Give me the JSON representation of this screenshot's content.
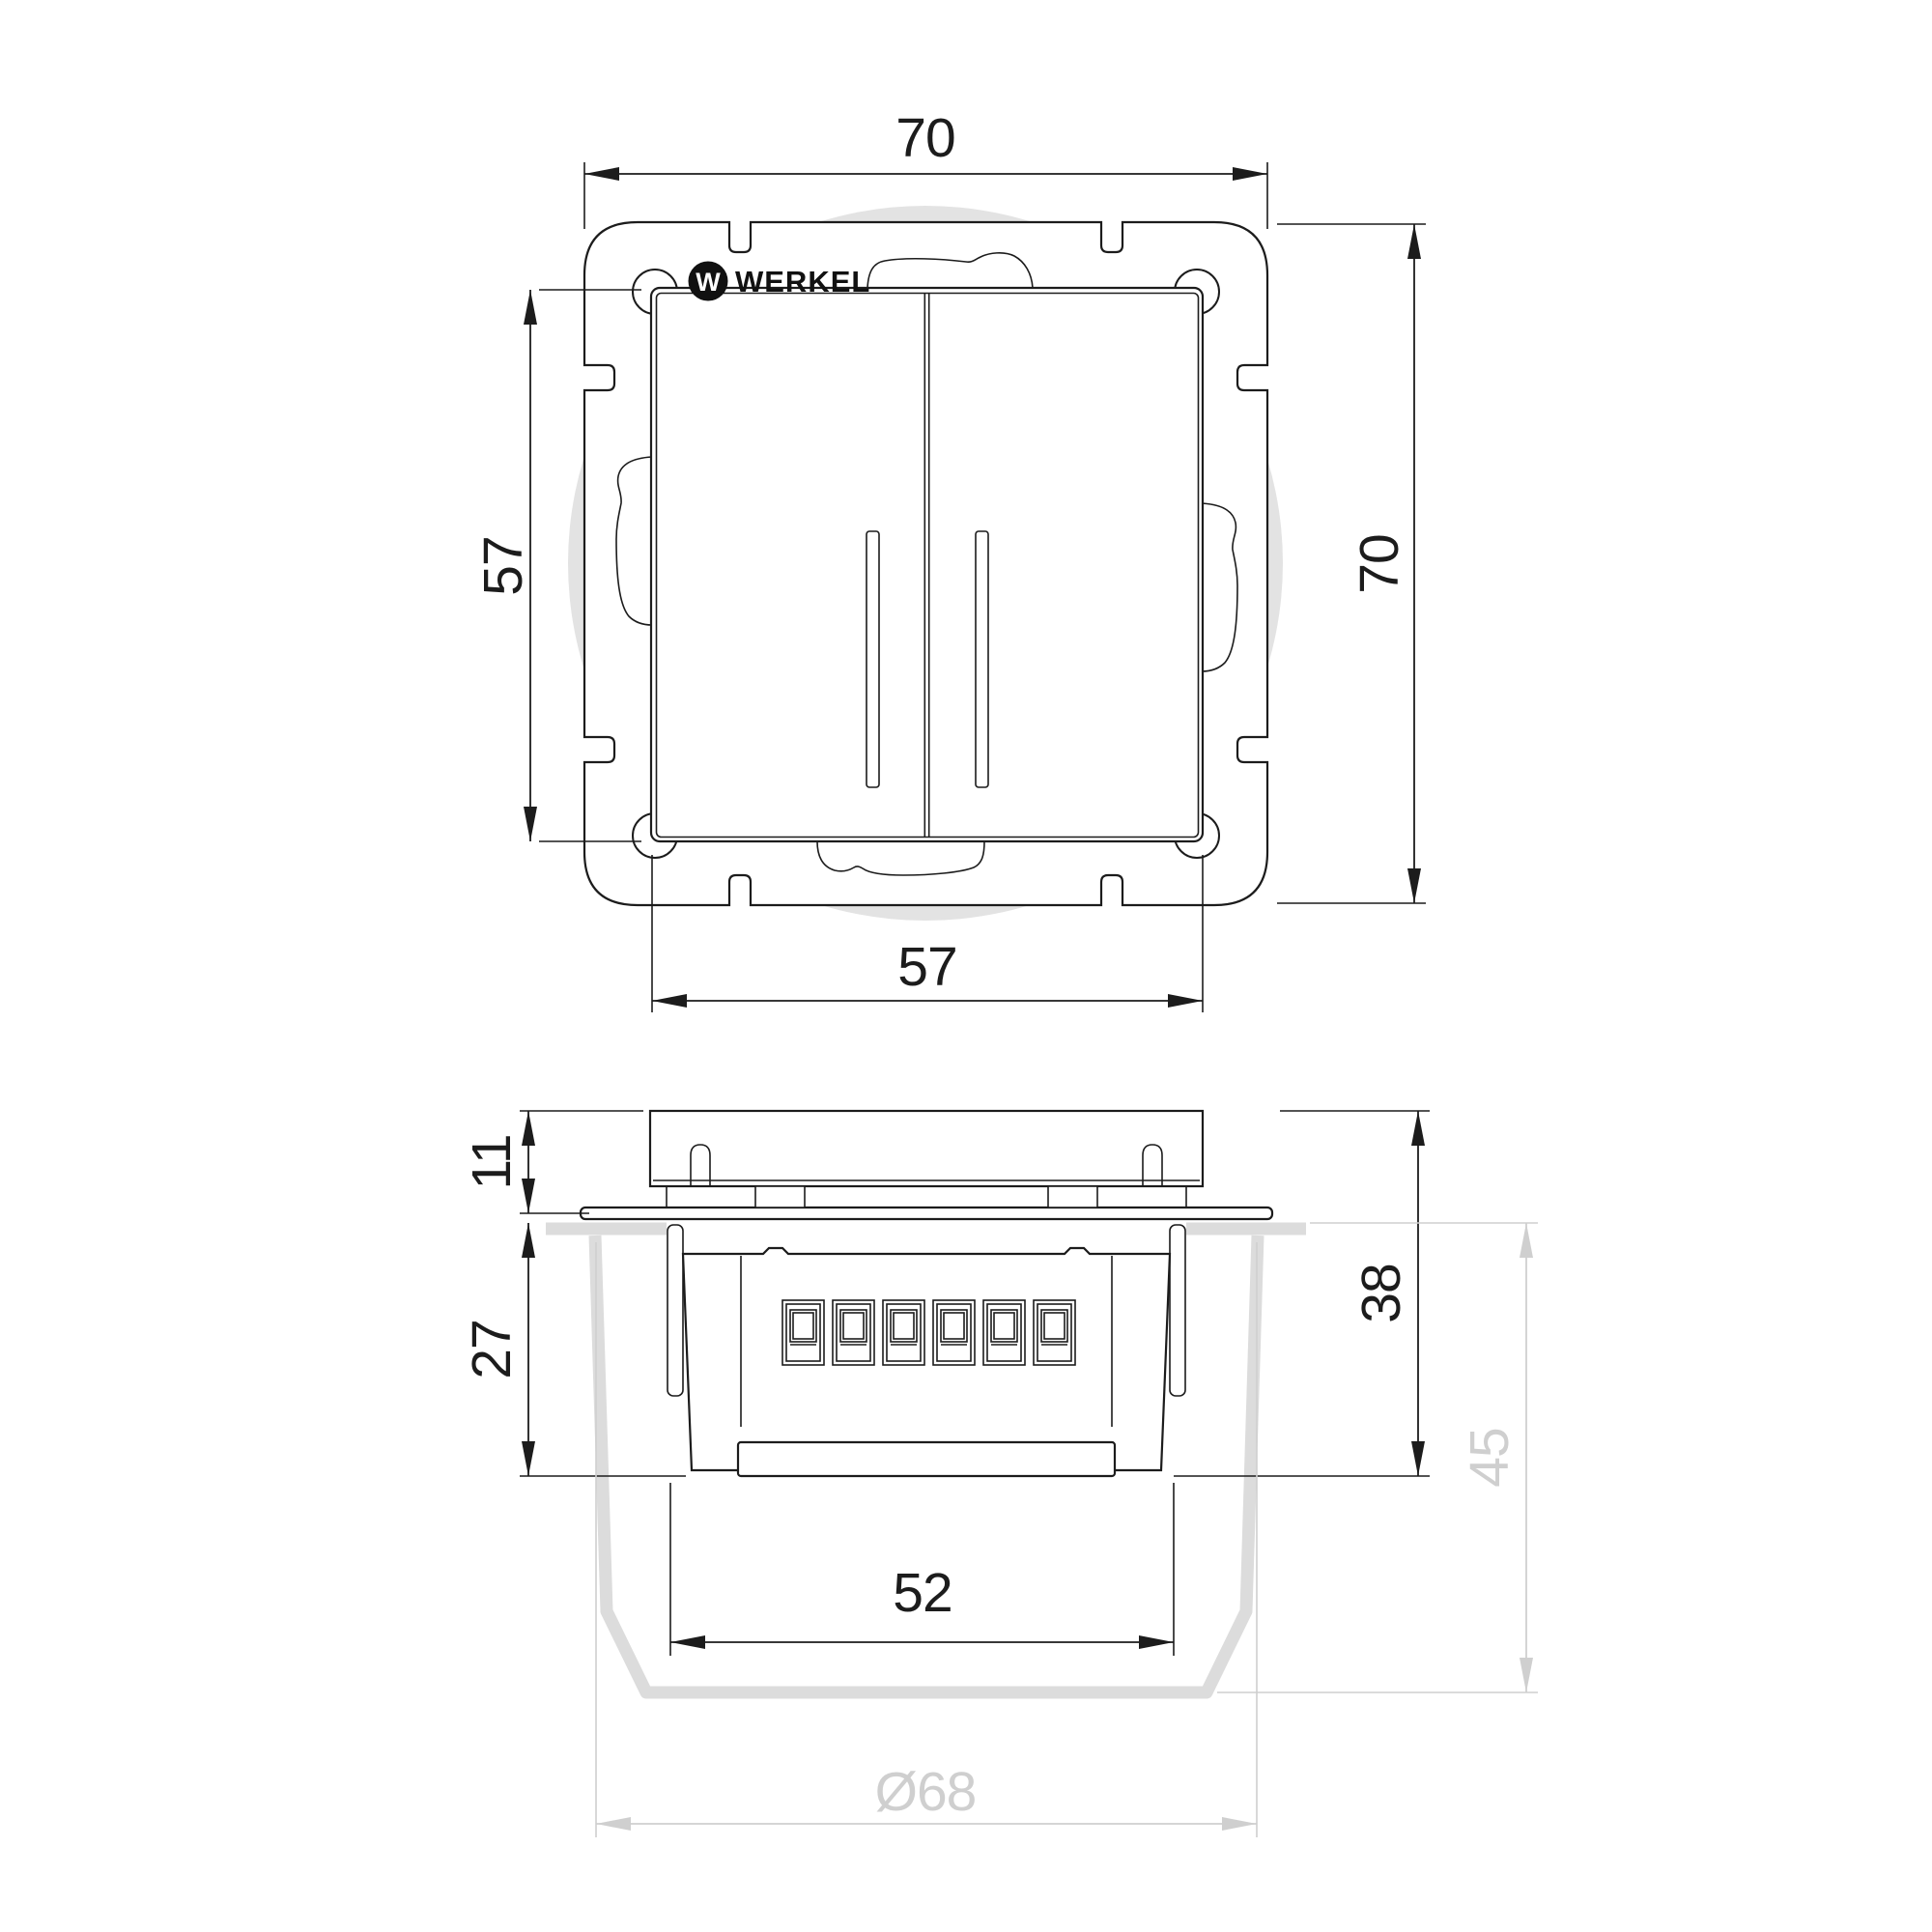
{
  "drawing": {
    "brand": {
      "logo_mark": "W",
      "logo_text": "WERKEL"
    },
    "front_view": {
      "dims": {
        "frame_width_top": "70",
        "frame_height_right": "70",
        "rocker_height_left": "57",
        "rocker_width_bottom": "57"
      }
    },
    "side_view": {
      "dims": {
        "rocker_protrusion": "11",
        "mechanism_depth": "27",
        "total_depth": "38",
        "box_depth": "45",
        "mechanism_width": "52",
        "box_diameter": "Ø68"
      }
    },
    "colors": {
      "line": "#1c1c1c",
      "dim_gray": "#cfcfcf",
      "box_gray": "#dcdcdc",
      "circle_gray": "#e3e3e3",
      "background": "#ffffff"
    }
  }
}
